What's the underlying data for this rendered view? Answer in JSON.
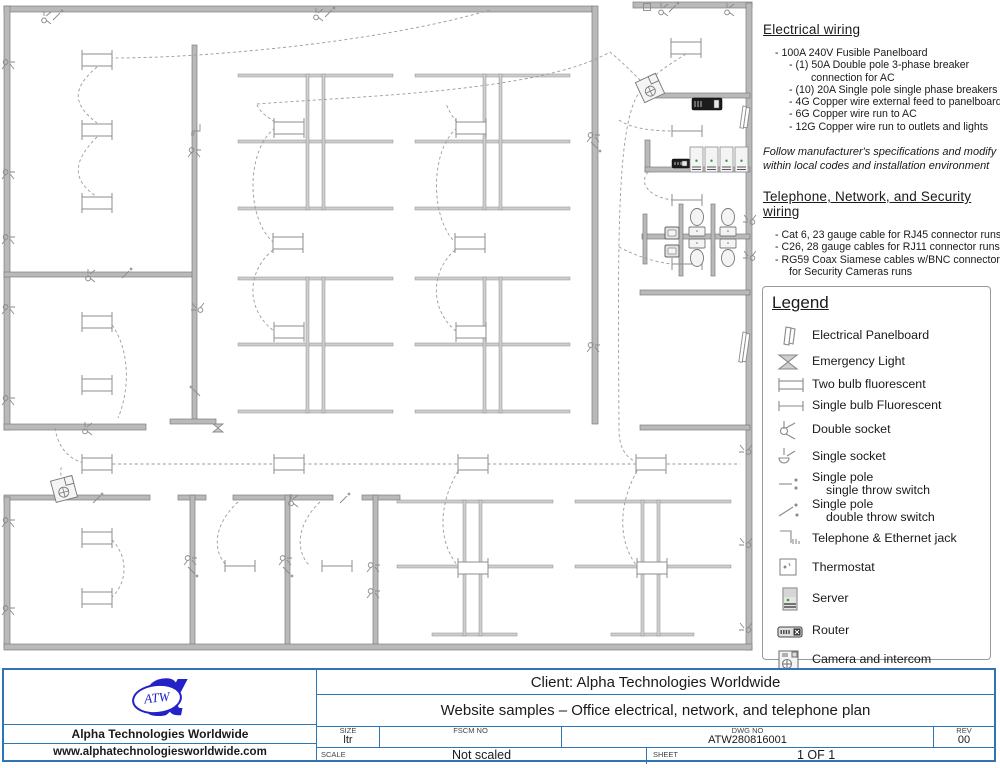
{
  "notes": {
    "electrical": {
      "title": "Electrical wiring",
      "lines": [
        {
          "t": "- 100A 240V Fusible Panelboard",
          "i": 1
        },
        {
          "t": "- (1) 50A Double pole 3-phase breaker",
          "i": 2
        },
        {
          "t": "connection for AC",
          "i": 3
        },
        {
          "t": "- (10) 20A Single pole single phase breakers",
          "i": 2
        },
        {
          "t": "- 4G Copper wire external feed to panelboard",
          "i": 2
        },
        {
          "t": "- 6G Copper wire run to AC",
          "i": 2
        },
        {
          "t": "- 12G Copper wire run to outlets and lights",
          "i": 2
        }
      ],
      "disclaimer": [
        "Follow manufacturer's specifications and modify",
        "within  local codes and installation environment"
      ]
    },
    "network": {
      "title": "Telephone, Network, and Security wiring",
      "lines": [
        {
          "t": "- Cat 6, 23 gauge cable for RJ45 connector runs",
          "i": 1
        },
        {
          "t": "- C26, 28 gauge cables for RJ11 connector runs",
          "i": 1
        },
        {
          "t": "- RG59 Coax Siamese cables w/BNC connectors",
          "i": 1
        },
        {
          "t": "for Security Cameras runs",
          "i": 2
        }
      ]
    }
  },
  "legend": {
    "title": "Legend",
    "items": [
      {
        "icon": "panelboard",
        "label": "Electrical Panelboard"
      },
      {
        "icon": "emergency-light",
        "label": "Emergency Light"
      },
      {
        "icon": "fluorescent-two-bulb",
        "label": "Two bulb fluorescent"
      },
      {
        "icon": "fluorescent-single-bulb",
        "label": "Single bulb Fluorescent"
      },
      {
        "icon": "double-socket",
        "label": "Double socket"
      },
      {
        "icon": "single-socket",
        "label": "Single socket"
      },
      {
        "icon": "spst-switch",
        "label": "Single pole",
        "label2": "single throw switch"
      },
      {
        "icon": "spdt-switch",
        "label": "Single pole",
        "label2": "double throw switch"
      },
      {
        "icon": "telephone-ethernet-jack",
        "label": "Telephone & Ethernet jack"
      },
      {
        "icon": "thermostat",
        "label": "Thermostat"
      },
      {
        "icon": "server",
        "label": "Server"
      },
      {
        "icon": "router",
        "label": "Router"
      },
      {
        "icon": "camera-intercom",
        "label": "Camera and intercom"
      }
    ]
  },
  "titleblock": {
    "client": "Client: Alpha Technologies Worldwide",
    "subtitle": "Website samples – Office electrical, network, and telephone plan",
    "company": "Alpha Technologies Worldwide",
    "website": "www.alphatechnologiesworldwide.com",
    "logo_text": "ATW",
    "logo_glyph": "α",
    "size_label": "SIZE",
    "size_value": "ltr",
    "fscm_label": "FSCM NO",
    "dwg_label": "DWG NO",
    "dwg_value": "ATW280816001",
    "rev_label": "REV",
    "rev_value": "00",
    "scale_label": "SCALE",
    "scale_value": "Not scaled",
    "sheet_label": "SHEET",
    "sheet_value": "1 OF 1"
  },
  "colors": {
    "accent_blue": "#2E75B6",
    "logo_blue": "#2422c7",
    "wall_gray": "#b9b9b9",
    "line_gray": "#8a8a8a",
    "wire_gray": "#9b9b9b",
    "led_green": "#3a9a3a"
  },
  "plan": {
    "walls": [
      [
        4,
        6,
        588,
        6
      ],
      [
        633,
        2,
        119,
        6
      ],
      [
        4,
        6,
        6,
        424
      ],
      [
        4,
        424,
        142,
        6
      ],
      [
        4,
        272,
        190,
        5
      ],
      [
        192,
        45,
        5,
        378
      ],
      [
        170,
        419,
        46,
        5
      ],
      [
        592,
        6,
        6,
        418
      ],
      [
        746,
        3,
        6,
        647
      ],
      [
        645,
        93,
        105,
        5
      ],
      [
        645,
        140,
        5,
        32
      ],
      [
        645,
        167,
        105,
        5
      ],
      [
        642,
        234,
        108,
        5
      ],
      [
        643,
        214,
        4,
        50
      ],
      [
        679,
        204,
        4,
        72
      ],
      [
        711,
        204,
        4,
        72
      ],
      [
        640,
        290,
        110,
        5
      ],
      [
        640,
        425,
        110,
        5
      ],
      [
        4,
        495,
        146,
        5
      ],
      [
        178,
        495,
        28,
        5
      ],
      [
        233,
        495,
        100,
        5
      ],
      [
        362,
        495,
        38,
        5
      ],
      [
        190,
        495,
        5,
        153
      ],
      [
        285,
        495,
        5,
        153
      ],
      [
        373,
        495,
        5,
        153
      ],
      [
        4,
        497,
        6,
        151
      ],
      [
        4,
        644,
        748,
        6
      ]
    ],
    "rails": [
      [
        238,
        74,
        155,
        3
      ],
      [
        238,
        140,
        155,
        3
      ],
      [
        238,
        207,
        155,
        3
      ],
      [
        238,
        277,
        155,
        3
      ],
      [
        238,
        343,
        155,
        3
      ],
      [
        238,
        410,
        155,
        3
      ],
      [
        306,
        74,
        3,
        136
      ],
      [
        322,
        74,
        3,
        136
      ],
      [
        306,
        277,
        3,
        136
      ],
      [
        322,
        277,
        3,
        136
      ],
      [
        415,
        74,
        155,
        3
      ],
      [
        415,
        140,
        155,
        3
      ],
      [
        415,
        207,
        155,
        3
      ],
      [
        415,
        277,
        155,
        3
      ],
      [
        415,
        343,
        155,
        3
      ],
      [
        415,
        410,
        155,
        3
      ],
      [
        483,
        74,
        3,
        136
      ],
      [
        499,
        74,
        3,
        136
      ],
      [
        483,
        277,
        3,
        136
      ],
      [
        499,
        277,
        3,
        136
      ],
      [
        397,
        500,
        156,
        3
      ],
      [
        397,
        565,
        156,
        3
      ],
      [
        432,
        633,
        85,
        3
      ],
      [
        463,
        500,
        3,
        136
      ],
      [
        479,
        500,
        3,
        136
      ],
      [
        575,
        500,
        156,
        3
      ],
      [
        575,
        565,
        156,
        3
      ],
      [
        611,
        633,
        83,
        3
      ],
      [
        641,
        500,
        3,
        136
      ],
      [
        657,
        500,
        3,
        136
      ]
    ],
    "fixtures2": [
      [
        97,
        60
      ],
      [
        97,
        130
      ],
      [
        97,
        203
      ],
      [
        97,
        322
      ],
      [
        97,
        385
      ],
      [
        289,
        128
      ],
      [
        288,
        243
      ],
      [
        289,
        332
      ],
      [
        471,
        128
      ],
      [
        470,
        243
      ],
      [
        471,
        332
      ],
      [
        686,
        48
      ],
      [
        97,
        464
      ],
      [
        289,
        464
      ],
      [
        473,
        464
      ],
      [
        651,
        464
      ],
      [
        97,
        538
      ],
      [
        97,
        598
      ],
      [
        473,
        568
      ],
      [
        652,
        568
      ]
    ],
    "fixtures1": [
      [
        687,
        131
      ],
      [
        687,
        200
      ],
      [
        687,
        264
      ],
      [
        240,
        566
      ],
      [
        337,
        566
      ]
    ],
    "wires": [
      "M82,57 C150,62 360,48 490,10",
      "M97,67 C72,88 72,104 97,123",
      "M97,137 C72,162 72,180 97,197",
      "M112,325 C130,350 130,390 118,418",
      "M55,428 C58,448 70,462 90,464",
      "M90,464 L740,464",
      "M257,104 C360,96 540,92 610,52 C622,62 632,72 644,84",
      "M275,128 C246,150 246,218 273,242",
      "M273,250 C246,272 246,310 274,331",
      "M457,128 C430,150 430,218 455,242",
      "M455,250 C430,272 430,310 456,331",
      "M275,122 C262,114 259,109 257,105",
      "M457,122 C450,114 448,108 446,104",
      "M641,90 C616,120 618,240 619,430 C619,450 628,462 645,464",
      "M619,120 C630,128 652,131 672,131",
      "M648,172 C638,184 650,197 672,200",
      "M619,247 C632,254 652,262 672,264",
      "M686,54 C660,70 654,76 651,80",
      "M112,540 C128,556 128,582 112,597",
      "M63,481 C60,473 60,470 62,466",
      "M238,502 C214,524 212,550 226,565",
      "M320,502 C297,524 295,550 309,565",
      "M458,471 C438,505 438,542 458,566",
      "M637,471 C618,505 618,542 637,566"
    ],
    "symbols": [
      [
        "s2",
        44,
        16,
        0
      ],
      [
        "sw",
        57,
        16,
        0
      ],
      [
        "s2",
        316,
        13,
        0
      ],
      [
        "sw",
        329,
        13,
        0
      ],
      [
        "th",
        647,
        7,
        0
      ],
      [
        "s2",
        661,
        8,
        0
      ],
      [
        "sw",
        673,
        8,
        0
      ],
      [
        "s2",
        727,
        8,
        0
      ],
      [
        "s2",
        10,
        62,
        90
      ],
      [
        "s2",
        10,
        172,
        90
      ],
      [
        "s2",
        10,
        237,
        90
      ],
      [
        "s2",
        10,
        307,
        90
      ],
      [
        "s2",
        10,
        398,
        90
      ],
      [
        "s2",
        10,
        520,
        90
      ],
      [
        "s2",
        10,
        608,
        90
      ],
      [
        "jk",
        196,
        128,
        90
      ],
      [
        "s2",
        196,
        150,
        90
      ],
      [
        "s2",
        196,
        310,
        -90
      ],
      [
        "sw",
        196,
        392,
        -90
      ],
      [
        "s2",
        88,
        274,
        0
      ],
      [
        "sw",
        126,
        274,
        0
      ],
      [
        "s2",
        85,
        427,
        0
      ],
      [
        "em",
        218,
        428,
        0
      ],
      [
        "s2",
        595,
        135,
        90
      ],
      [
        "sw",
        595,
        146,
        90
      ],
      [
        "s2",
        595,
        345,
        90
      ],
      [
        "s2",
        748,
        222,
        -90
      ],
      [
        "s2",
        748,
        258,
        -90
      ],
      [
        "sw",
        97,
        499,
        0
      ],
      [
        "sw",
        344,
        499,
        0
      ],
      [
        "s2",
        291,
        499,
        0
      ],
      [
        "s2",
        192,
        558,
        90
      ],
      [
        "sw",
        192,
        571,
        90
      ],
      [
        "s2",
        287,
        558,
        90
      ],
      [
        "sw",
        287,
        571,
        90
      ],
      [
        "s2",
        375,
        565,
        90
      ],
      [
        "s2",
        375,
        591,
        90
      ],
      [
        "s2",
        744,
        452,
        -90
      ],
      [
        "s2",
        744,
        545,
        -90
      ],
      [
        "s2",
        744,
        630,
        -90
      ]
    ],
    "cameras": [
      [
        650,
        88,
        -25
      ],
      [
        64,
        489,
        -15
      ]
    ],
    "routers": [
      [
        692,
        98,
        30,
        12
      ],
      [
        672,
        159,
        18,
        9
      ]
    ],
    "servers": {
      "x": 690,
      "y": 147,
      "count": 4,
      "w": 13,
      "h": 25,
      "gap": 15
    },
    "panelboards": [
      [
        743,
        106,
        22
      ],
      [
        743,
        332,
        30
      ]
    ],
    "toilets": [
      [
        697,
        "up"
      ],
      [
        728,
        "up"
      ],
      [
        697,
        "dn"
      ],
      [
        728,
        "dn"
      ]
    ],
    "sinks": [
      [
        665,
        227
      ],
      [
        665,
        245
      ]
    ]
  }
}
